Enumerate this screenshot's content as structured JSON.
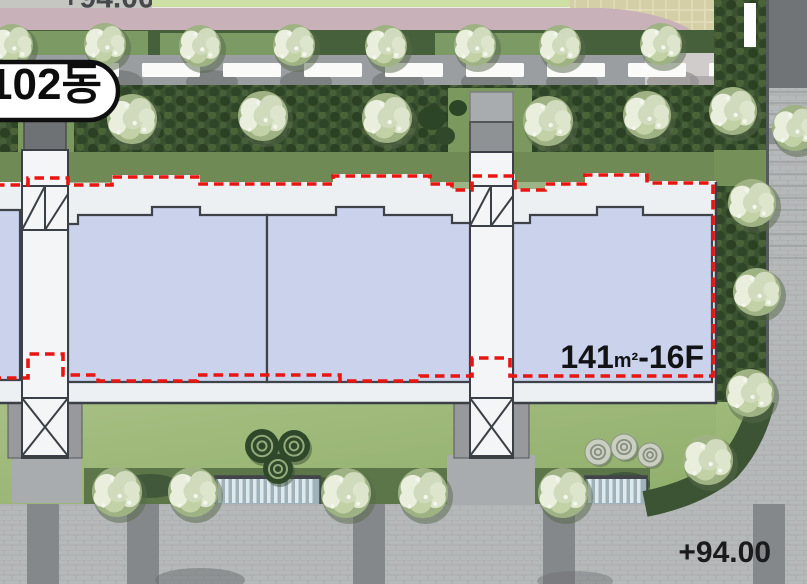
{
  "title": "Apartment site plan - building 102",
  "labels": {
    "building_label": "102동",
    "unit_area_value": "141",
    "unit_area_unit": "m²",
    "unit_floor_suffix": "-16F",
    "elevation_bottom": "+94.00",
    "elevation_top_clipped": "+94.00"
  },
  "colors": {
    "unit_fill": "#cbd2ec",
    "building_band": "#edf0f3",
    "outline_dark": "#3b4047",
    "boundary_red": "#e81511",
    "road_pink": "#c8b1b8",
    "path_gray": "#9b9ea1",
    "hedge_green": "#3a5230",
    "lawn_green": "#9cb97b",
    "cobble_gray": "#b6b9ba"
  },
  "decor": {
    "trees": [
      {
        "x": 12,
        "y": 45,
        "r": 23
      },
      {
        "x": 105,
        "y": 44,
        "r": 23
      },
      {
        "x": 200,
        "y": 46,
        "r": 23
      },
      {
        "x": 294,
        "y": 45,
        "r": 23
      },
      {
        "x": 386,
        "y": 46,
        "r": 23
      },
      {
        "x": 475,
        "y": 45,
        "r": 23
      },
      {
        "x": 560,
        "y": 46,
        "r": 23
      },
      {
        "x": 661,
        "y": 44,
        "r": 23
      },
      {
        "x": 132,
        "y": 119,
        "r": 27
      },
      {
        "x": 263,
        "y": 116,
        "r": 27
      },
      {
        "x": 387,
        "y": 118,
        "r": 27
      },
      {
        "x": 548,
        "y": 121,
        "r": 27
      },
      {
        "x": 647,
        "y": 115,
        "r": 26
      },
      {
        "x": 733,
        "y": 111,
        "r": 26
      },
      {
        "x": 795,
        "y": 128,
        "r": 25
      },
      {
        "x": 752,
        "y": 203,
        "r": 26
      },
      {
        "x": 757,
        "y": 292,
        "r": 26
      },
      {
        "x": 750,
        "y": 393,
        "r": 26
      },
      {
        "x": 708,
        "y": 460,
        "r": 27
      },
      {
        "x": 117,
        "y": 492,
        "r": 27
      },
      {
        "x": 193,
        "y": 492,
        "r": 27
      },
      {
        "x": 346,
        "y": 493,
        "r": 27
      },
      {
        "x": 423,
        "y": 493,
        "r": 27
      },
      {
        "x": 563,
        "y": 493,
        "r": 27
      }
    ],
    "shrubs_dark": [
      {
        "x": 262,
        "y": 446,
        "r": 17
      },
      {
        "x": 294,
        "y": 446,
        "r": 16
      },
      {
        "x": 278,
        "y": 469,
        "r": 15
      }
    ],
    "shrubs_light": [
      {
        "x": 598,
        "y": 452,
        "r": 13
      },
      {
        "x": 624,
        "y": 447,
        "r": 13
      },
      {
        "x": 650,
        "y": 455,
        "r": 12
      }
    ],
    "water_features": [
      {
        "x": 215,
        "y": 476,
        "w": 105,
        "h": 30
      },
      {
        "x": 585,
        "y": 476,
        "w": 62,
        "h": 30
      }
    ],
    "road_bands_x": [
      27,
      127,
      353,
      543,
      753
    ],
    "crosswalk_dashes": {
      "y": 63,
      "height": 14,
      "dash": 58,
      "gap": 23,
      "start": -20,
      "end": 738
    },
    "path_tree_shadow_x": [
      12,
      105,
      200,
      294,
      386,
      475,
      560,
      661
    ]
  }
}
